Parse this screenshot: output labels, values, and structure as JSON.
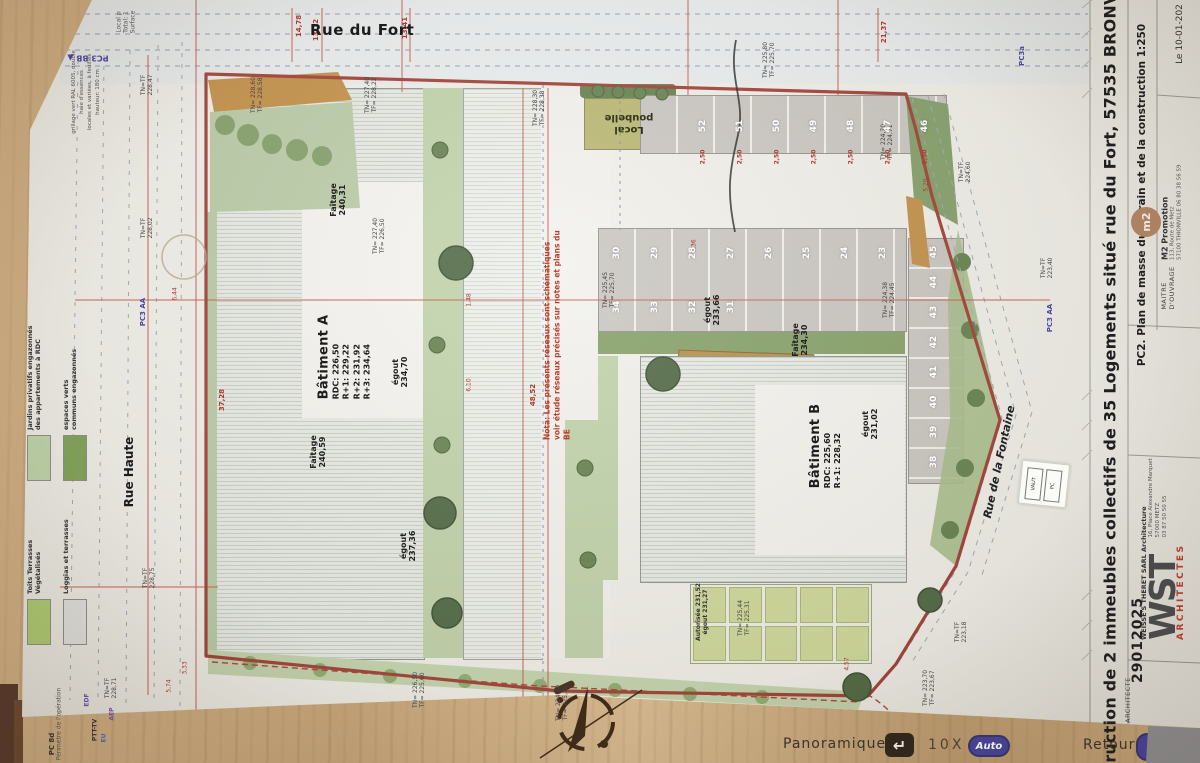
{
  "viewer": {
    "mode": "Panoramique",
    "zoom": "10X",
    "auto": "Auto",
    "back": "Retour"
  },
  "titleblock": {
    "project_title": "struction de 2 immeubles collectifs de 35 Logements situé rue du Fort, 57535 BRONVAUX",
    "doc_ref": "PC2. Plan de masse du terrain et de la construction 1:250",
    "date": "Le 10-01-202",
    "dossier": "29012025",
    "architecte_label": "ARCHITECTE",
    "architect_firm": "WEISSE'S THERET SARL Architecture",
    "architect_addr1": "16, Place Alexandre Marquet",
    "architect_addr2": "57000 METZ",
    "architect_tel": "03 87 50 50 55",
    "logo_wst": "WST",
    "logo_wst_sub": "ARCHITECTES",
    "moa_label": "MAITRE D'OUVRAGE",
    "moa_name": "M2 Promotion",
    "moa_addr1": "113, Route de Metz",
    "moa_addr2": "57100 THIONVILLE 06 80 38 56 59",
    "logo_m2": "m2"
  },
  "legend": {
    "items": [
      {
        "label": "Toits Terrasses\nVégétalisés",
        "color": "#a9c46f"
      },
      {
        "label": "Jardins privatifs engazonnés\ndes appartements à RDC",
        "color": "#b9cda3"
      },
      {
        "label": "Loggias et terrasses",
        "color": "#d8d8d3"
      },
      {
        "label": "espaces verts\ncommuns engazonnés",
        "color": "#7f9f59"
      }
    ]
  },
  "plan": {
    "streets": {
      "top": "Rue du Fort",
      "left": "Rue Haute",
      "right": "Rue de la Fontaine"
    },
    "building_a": {
      "name": "Bâtiment A",
      "levels": [
        "RDC: 226,50",
        "R+1: 229,22",
        "R+2: 231,92",
        "R+3: 234,64"
      ]
    },
    "building_b": {
      "name": "Bâtiment B",
      "levels": [
        "RDC: 225,60",
        "R+1: 228,32"
      ]
    },
    "nota": "Nota: Les présents réseaux sont schématiques\nvoir étude réseaux précisés sur notes et plans du BE",
    "local_poubelle": "Local\npoubelle",
    "sticker": {
      "line1": "VAUT",
      "line2": "PC"
    },
    "parking_top": [
      "52",
      "51",
      "50",
      "49",
      "48",
      "47",
      "46"
    ],
    "parking_mid": [
      "30",
      "29",
      "28",
      "27",
      "26",
      "25",
      "24",
      "23"
    ],
    "parking_mid2": [
      "34",
      "33",
      "32",
      "31"
    ],
    "parking_right": [
      "45",
      "44",
      "43",
      "42",
      "41",
      "40",
      "39",
      "38"
    ],
    "dim_250": "2,50",
    "labels": [
      {
        "t": "Faîtage\n240,31",
        "x": 338,
        "y": 200,
        "r": -90,
        "s": 8,
        "c": "#222",
        "w": 700
      },
      {
        "t": "égout\n234,70",
        "x": 400,
        "y": 372,
        "r": -90,
        "s": 8,
        "c": "#222",
        "w": 700
      },
      {
        "t": "égout\n237,36",
        "x": 408,
        "y": 546,
        "r": -90,
        "s": 8,
        "c": "#222",
        "w": 700
      },
      {
        "t": "Faîtage\n240,59",
        "x": 318,
        "y": 452,
        "r": -90,
        "s": 8,
        "c": "#222",
        "w": 700
      },
      {
        "t": "Faîtage\n234,30",
        "x": 800,
        "y": 340,
        "r": -90,
        "s": 8,
        "c": "#222",
        "w": 700
      },
      {
        "t": "égout\n231,02",
        "x": 870,
        "y": 424,
        "r": -90,
        "s": 8,
        "c": "#222",
        "w": 700
      },
      {
        "t": "égout\n233,66",
        "x": 712,
        "y": 310,
        "r": -90,
        "s": 8,
        "c": "#222",
        "w": 700
      },
      {
        "t": "Autorisée 231,52\négout 231,27",
        "x": 703,
        "y": 612,
        "r": -90,
        "s": 6,
        "c": "#333",
        "w": 600
      },
      {
        "t": "TN= 225,44\nTF= 225,31",
        "x": 745,
        "y": 618,
        "r": -90,
        "s": 6,
        "c": "#444"
      },
      {
        "t": "TN= 224,38\nTF= 224,45",
        "x": 890,
        "y": 300,
        "r": -90,
        "s": 6,
        "c": "#444"
      },
      {
        "t": "TN= 225,45\nTF= 225,70",
        "x": 610,
        "y": 290,
        "r": -90,
        "s": 6,
        "c": "#444"
      },
      {
        "t": "TN= 228,60\nTF= 228,58",
        "x": 258,
        "y": 95,
        "r": -90,
        "s": 6,
        "c": "#444"
      },
      {
        "t": "TN=TF\n228,47",
        "x": 148,
        "y": 85,
        "r": -90,
        "s": 6,
        "c": "#444"
      },
      {
        "t": "TN=TF\n228,02",
        "x": 148,
        "y": 228,
        "r": -90,
        "s": 6,
        "c": "#444"
      },
      {
        "t": "TN=TF\n228,75",
        "x": 150,
        "y": 578,
        "r": -90,
        "s": 6,
        "c": "#444"
      },
      {
        "t": "TN=TF\n228,71",
        "x": 112,
        "y": 688,
        "r": -90,
        "s": 6,
        "c": "#444"
      },
      {
        "t": "TN= 227,40\nTF= 226,50",
        "x": 380,
        "y": 236,
        "r": -90,
        "s": 6,
        "c": "#444"
      },
      {
        "t": "TN= 227,40\nTF= 228,22",
        "x": 372,
        "y": 95,
        "r": -90,
        "s": 6,
        "c": "#444"
      },
      {
        "t": "TN= 228,30\nTF= 228,38",
        "x": 540,
        "y": 108,
        "r": -90,
        "s": 6,
        "c": "#444"
      },
      {
        "t": "TN= 225,80\nTF= 225,70",
        "x": 770,
        "y": 60,
        "r": -90,
        "s": 6,
        "c": "#444"
      },
      {
        "t": "TN= 224,70\nTF= 224,71",
        "x": 888,
        "y": 142,
        "r": -90,
        "s": 6,
        "c": "#444"
      },
      {
        "t": "TN=TF\n224,60",
        "x": 966,
        "y": 172,
        "r": -90,
        "s": 6,
        "c": "#444"
      },
      {
        "t": "TN=TF\n223,40",
        "x": 1048,
        "y": 268,
        "r": -90,
        "s": 6,
        "c": "#444"
      },
      {
        "t": "TN= 223,70\nTF= 223,67",
        "x": 930,
        "y": 688,
        "r": -90,
        "s": 6,
        "c": "#444"
      },
      {
        "t": "TN=TF\n223,18",
        "x": 962,
        "y": 632,
        "r": -90,
        "s": 6,
        "c": "#444"
      },
      {
        "t": "TN= 226,50\nTF= 225,60",
        "x": 420,
        "y": 690,
        "r": -90,
        "s": 6,
        "c": "#444"
      },
      {
        "t": "TN= 224,79\nTF= 225,25",
        "x": 563,
        "y": 703,
        "r": -90,
        "s": 6,
        "c": "#444"
      },
      {
        "t": "14,78",
        "x": 299,
        "y": 26,
        "r": -90,
        "s": 7,
        "c": "#b0392f",
        "w": 700
      },
      {
        "t": "13,12",
        "x": 316,
        "y": 30,
        "r": -90,
        "s": 7,
        "c": "#b0392f",
        "w": 700
      },
      {
        "t": "13,41",
        "x": 405,
        "y": 28,
        "r": -90,
        "s": 7,
        "c": "#b0392f",
        "w": 700
      },
      {
        "t": "21,37",
        "x": 884,
        "y": 32,
        "r": -90,
        "s": 7,
        "c": "#b0392f",
        "w": 700
      },
      {
        "t": "37,28",
        "x": 222,
        "y": 400,
        "r": -90,
        "s": 7,
        "c": "#b0392f",
        "w": 700
      },
      {
        "t": "48,52",
        "x": 533,
        "y": 395,
        "r": -90,
        "s": 7,
        "c": "#b0392f",
        "w": 700
      },
      {
        "t": "5,74",
        "x": 170,
        "y": 686,
        "r": -90,
        "s": 6,
        "c": "#b0392f"
      },
      {
        "t": "3,33",
        "x": 186,
        "y": 668,
        "r": -90,
        "s": 6,
        "c": "#b0392f"
      },
      {
        "t": "6,44",
        "x": 176,
        "y": 294,
        "r": -90,
        "s": 6,
        "c": "#b0392f"
      },
      {
        "t": "7,36",
        "x": 695,
        "y": 246,
        "r": -90,
        "s": 6,
        "c": "#b0392f"
      },
      {
        "t": "4,57",
        "x": 848,
        "y": 664,
        "r": -90,
        "s": 6,
        "c": "#b0392f"
      },
      {
        "t": "5,20",
        "x": 927,
        "y": 185,
        "r": -90,
        "s": 6,
        "c": "#b0392f"
      },
      {
        "t": "1,48",
        "x": 470,
        "y": 300,
        "r": -90,
        "s": 6,
        "c": "#b0392f"
      },
      {
        "t": "6,10",
        "x": 470,
        "y": 385,
        "r": -90,
        "s": 6,
        "c": "#b0392f"
      },
      {
        "t": "PC3 BB ▲",
        "x": 88,
        "y": 58,
        "r": 180,
        "s": 8,
        "c": "#4b47a0",
        "w": 700
      },
      {
        "t": "PC3 AA",
        "x": 143,
        "y": 312,
        "r": -90,
        "s": 7,
        "c": "#4b47a0",
        "w": 700
      },
      {
        "t": "PC3 AA",
        "x": 1050,
        "y": 318,
        "r": -90,
        "s": 7,
        "c": "#4b47a0",
        "w": 700
      },
      {
        "t": "PC3a",
        "x": 1022,
        "y": 56,
        "r": -90,
        "s": 7,
        "c": "#4b47a0",
        "w": 700
      },
      {
        "t": "PC 8d",
        "x": 52,
        "y": 744,
        "r": -90,
        "s": 7,
        "c": "#333",
        "w": 700
      },
      {
        "t": "EDF",
        "x": 88,
        "y": 700,
        "r": -90,
        "s": 6,
        "c": "#6a4fa5",
        "w": 700
      },
      {
        "t": "PTT-TV",
        "x": 96,
        "y": 730,
        "r": -90,
        "s": 6,
        "c": "#333",
        "w": 700
      },
      {
        "t": "EU",
        "x": 105,
        "y": 738,
        "r": -90,
        "s": 6,
        "c": "#3b6fb5",
        "w": 700
      },
      {
        "t": "AEP",
        "x": 113,
        "y": 714,
        "r": -90,
        "s": 6,
        "c": "#7a4fa0",
        "w": 700
      },
      {
        "t": "Périmètre de l'opération",
        "x": 60,
        "y": 724,
        "r": -90,
        "s": 6,
        "c": "#555"
      },
      {
        "t": "Local p",
        "x": 120,
        "y": 22,
        "r": -90,
        "s": 6,
        "c": "#555"
      },
      {
        "t": "Total: 1",
        "x": 127,
        "y": 22,
        "r": -90,
        "s": 6,
        "c": "#555"
      },
      {
        "t": "Surface",
        "x": 134,
        "y": 22,
        "r": -90,
        "s": 6,
        "c": "#555"
      },
      {
        "t": "grillage vert RAL 6005, double",
        "x": 74,
        "y": 92,
        "r": -90,
        "s": 5.5,
        "c": "#555"
      },
      {
        "t": "haie d'essences",
        "x": 82,
        "y": 92,
        "r": -90,
        "s": 5.5,
        "c": "#555"
      },
      {
        "t": "locales et variées, à feuilles",
        "x": 90,
        "y": 92,
        "r": -90,
        "s": 5.5,
        "c": "#555"
      },
      {
        "t": "hauteur: 180 cm",
        "x": 98,
        "y": 92,
        "r": -90,
        "s": 5.5,
        "c": "#555"
      }
    ]
  }
}
